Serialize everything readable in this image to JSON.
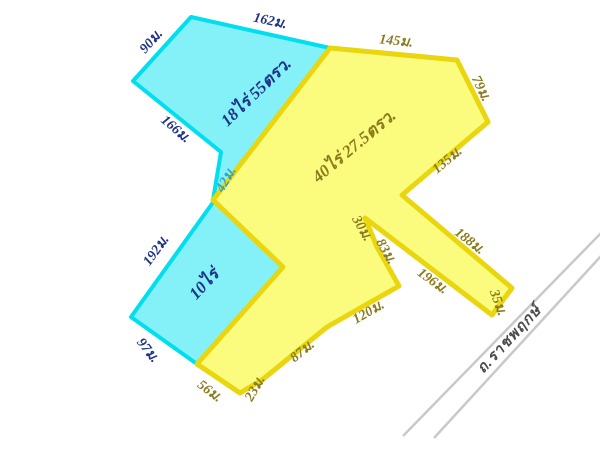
{
  "diagram": {
    "type": "land-plot-survey",
    "background": "#ffffff",
    "plots": [
      {
        "id": "plot-18-rai",
        "area_label": "18ไร่ 55ตรว.",
        "fill": "#84f1f8",
        "stroke": "#00def0",
        "label_color": "#1e3386",
        "edges": [
          "90ม.",
          "162ม.",
          "166ม.",
          "42ม."
        ]
      },
      {
        "id": "plot-40-rai",
        "area_label": "40ไร่ 27.5ตรว.",
        "fill": "#fbfb7e",
        "stroke": "#e9d60e",
        "label_color": "#8b7b1c",
        "edges": [
          "145ม.",
          "79ม.",
          "135ม.",
          "188ม.",
          "35ม.",
          "196ม.",
          "30ม.",
          "83ม.",
          "120ม.",
          "87ม.",
          "23ม.",
          "56ม."
        ]
      },
      {
        "id": "plot-10-rai",
        "area_label": "10ไร่",
        "fill": "#84f1f8",
        "stroke": "#00def0",
        "label_color": "#1e3386",
        "edges": [
          "192ม.",
          "97ม."
        ]
      }
    ],
    "road": {
      "name": "ถ.ราชพฤกษ์",
      "line_color": "#c9c9c9",
      "text_color": "#4b4b4b"
    }
  }
}
